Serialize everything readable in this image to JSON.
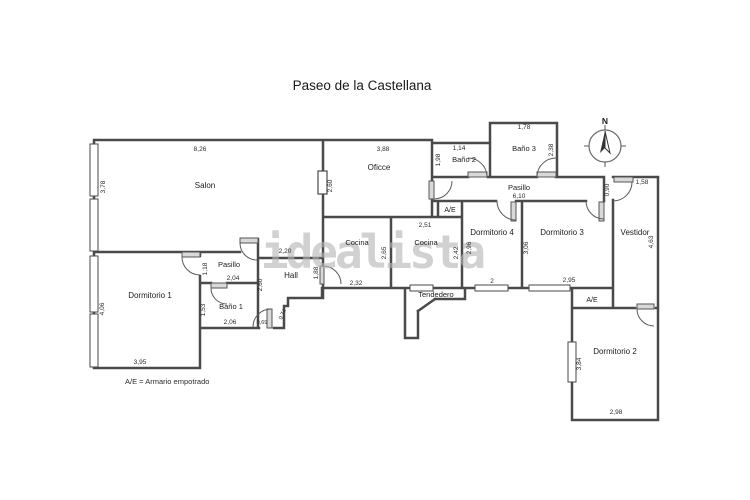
{
  "title": "Paseo de la Castellana",
  "watermark": "idealista",
  "legend": "A/E = Armario empotrado",
  "compass": {
    "north": "N"
  },
  "labels": {
    "ae": "A/E",
    "salon": {
      "name": "Salon",
      "w": "8,26",
      "h": "3,78"
    },
    "oficce": {
      "name": "Oficce",
      "w": "3,88",
      "h": "2,60"
    },
    "bano2": {
      "name": "Baño 2",
      "w": "1,14",
      "h": "1,98"
    },
    "bano3": {
      "name": "Baño 3",
      "w": "1,78",
      "h": "2,38"
    },
    "pasillo": {
      "name": "Pasillo",
      "len": "6,10",
      "end": "0,90"
    },
    "vestidor": {
      "name": "Vestidor",
      "w": "1,58",
      "h": "4,63"
    },
    "dorm4": {
      "name": "Dormitorio 4",
      "h": "2,96",
      "win": "2"
    },
    "dorm3": {
      "name": "Dormitorio 3",
      "h": "3,06",
      "win": "2,95"
    },
    "dorm2": {
      "name": "Dormitorio 2",
      "h": "3,84",
      "w": "2,98"
    },
    "dorm1": {
      "name": "Dormitorio 1",
      "h": "4,06",
      "w": "3,95"
    },
    "cocina_a": {
      "name": "Cocina",
      "h": "2,65",
      "w": "2,32"
    },
    "cocina_b": {
      "name": "Cocina",
      "w": "2,51",
      "h": "2,42"
    },
    "tendedero": {
      "name": "Tendedero"
    },
    "pasillo2": {
      "name": "Pasillo",
      "w": "2,04",
      "door": "1,18"
    },
    "bano1": {
      "name": "Baño 1",
      "h": "1,53",
      "w": "2,06"
    },
    "hall": {
      "name": "Hall",
      "w": "2,20",
      "left": "2,60",
      "right": "1,88",
      "entry_w": "0,69",
      "entry_side": "0,74"
    }
  }
}
